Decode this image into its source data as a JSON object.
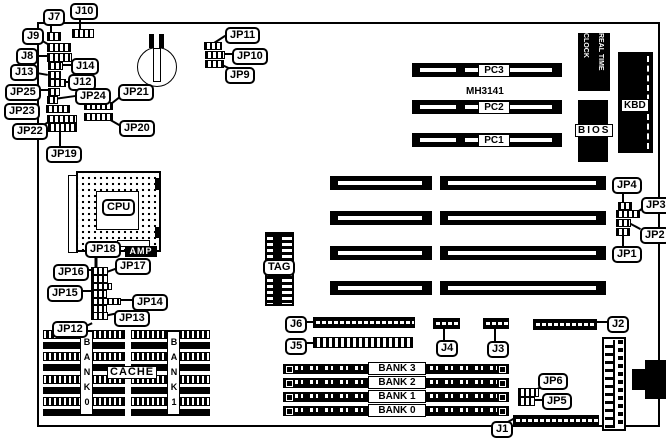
{
  "diagram": {
    "chip_id": "MH3141",
    "labels": {
      "j7": "J7",
      "j10": "J10",
      "j9": "J9",
      "j8": "J8",
      "j14": "J14",
      "j13": "J13",
      "j12": "J12",
      "jp25": "JP25",
      "jp24": "JP24",
      "jp21": "JP21",
      "jp23": "JP23",
      "jp22": "JP22",
      "jp20": "JP20",
      "jp19": "JP19",
      "jp11": "JP11",
      "jp10": "JP10",
      "jp9": "JP9",
      "jp18": "JP18",
      "jp17": "JP17",
      "jp16": "JP16",
      "jp15": "JP15",
      "jp14": "JP14",
      "jp13": "JP13",
      "jp12": "JP12",
      "jp4": "JP4",
      "jp3": "JP3",
      "jp2": "JP2",
      "jp1": "JP1",
      "j6": "J6",
      "j5": "J5",
      "j4": "J4",
      "j3": "J3",
      "j2": "J2",
      "j1": "J1",
      "jp6": "JP6",
      "jp5": "JP5",
      "cpu": "CPU",
      "amp": "AMP",
      "tag": "TAG",
      "cache": "CACHE",
      "bios": "BIOS",
      "kbd": "KBD",
      "rtc_line1": "REAL TIME",
      "rtc_line2": "CLOCK"
    },
    "pc_slots": [
      "PC3",
      "PC2",
      "PC1"
    ],
    "simm_banks": [
      "BANK 3",
      "BANK 2",
      "BANK 1",
      "BANK 0"
    ],
    "cache_banks": [
      "BANK0",
      "BANK1"
    ],
    "colors": {
      "board_bg": "#ffffff",
      "ink": "#000000"
    }
  }
}
